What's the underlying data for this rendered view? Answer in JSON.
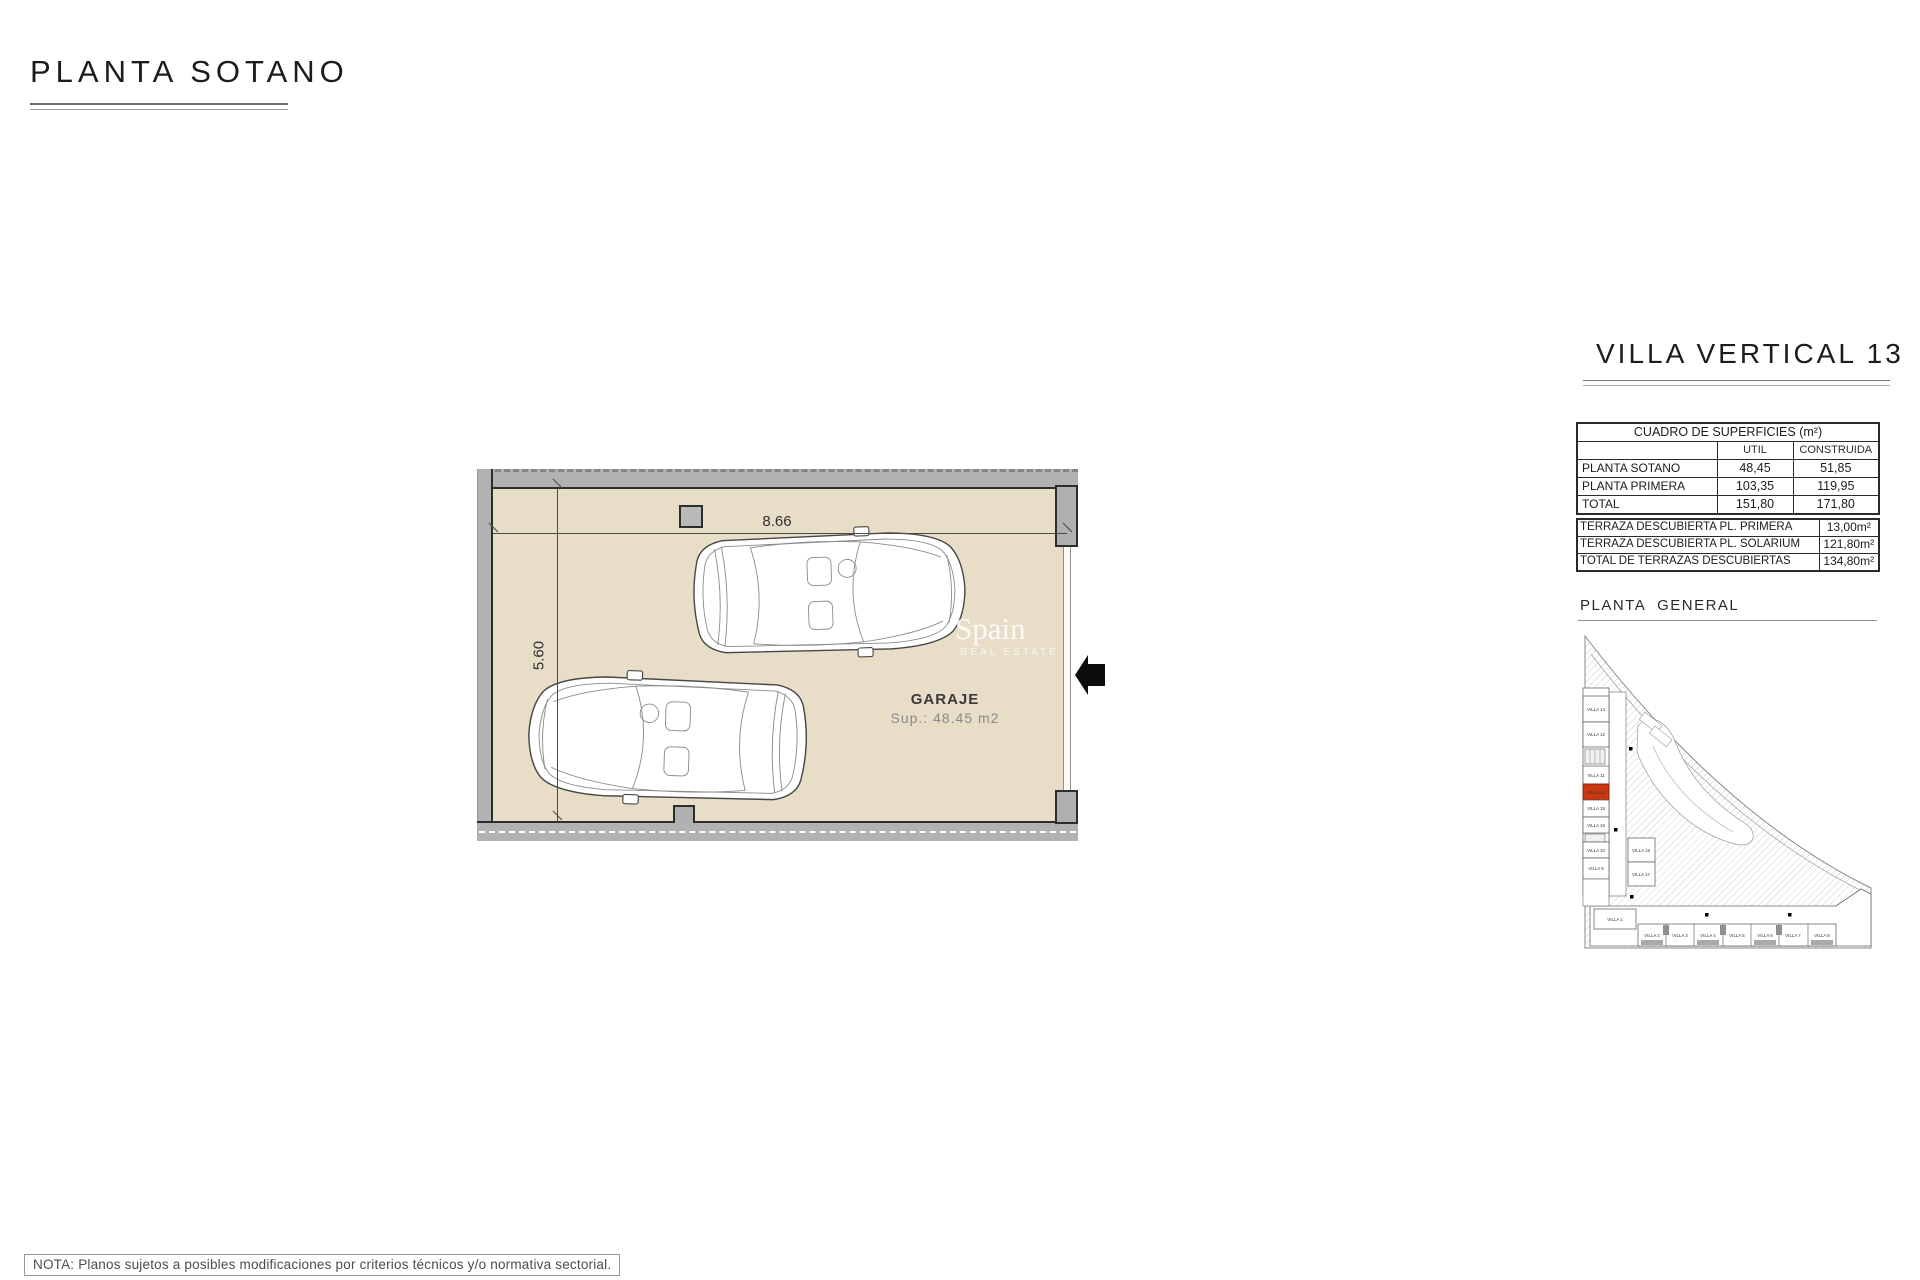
{
  "sheet": {
    "title": "PLANTA SOTANO",
    "note": "NOTA: Planos sujetos a posibles modificaciones por criterios técnicos y/o normativa sectorial."
  },
  "plan": {
    "room_label": "GARAJE",
    "room_area": "Sup.: 48.45 m2",
    "width_dim": "8.66",
    "height_dim": "5.60",
    "floor_color": "#e8dec8",
    "wall_color": "#b2b2b2",
    "watermark": {
      "line1": "Spain",
      "line2": "REAL ESTATE"
    }
  },
  "panel": {
    "title": "VILLA VERTICAL 13",
    "surfaces": {
      "title": "CUADRO DE SUPERFICIES (m²)",
      "columns": {
        "util": "UTIL",
        "construida": "CONSTRUIDA"
      },
      "rows": [
        {
          "label": "PLANTA SOTANO",
          "util": "48,45",
          "construida": "51,85"
        },
        {
          "label": "PLANTA PRIMERA",
          "util": "103,35",
          "construida": "119,95"
        },
        {
          "label": "TOTAL",
          "util": "151,80",
          "construida": "171,80"
        }
      ]
    },
    "terraces": {
      "rows": [
        {
          "label": "TERRAZA DESCUBIERTA PL. PRIMERA",
          "value": "13,00m²"
        },
        {
          "label": "TERRAZA DESCUBIERTA PL. SOLARIUM",
          "value": "121,80m²"
        },
        {
          "label": "TOTAL DE TERRAZAS DESCUBIERTAS",
          "value": "134,80m²"
        }
      ]
    },
    "site": {
      "title": "PLANTA GENERAL",
      "highlight_color": "#cc3711",
      "highlighted_villa": "VILLA 13",
      "left_villas": [
        "VILLA 14",
        "VILLA 12",
        "VILLA 11",
        "VILLA 13",
        "VILLA 15",
        "VILLA 16",
        "VILLA 10",
        "VILLA 9"
      ],
      "inner_villas": [
        "VILLA 18",
        "VILLA 17"
      ],
      "bottom_villas": [
        "VILLA 1",
        "VILLA 2",
        "VILLA 3",
        "VILLA 4",
        "VILLA 5",
        "VILLA 6",
        "VILLA 7",
        "VILLA 8"
      ]
    }
  }
}
